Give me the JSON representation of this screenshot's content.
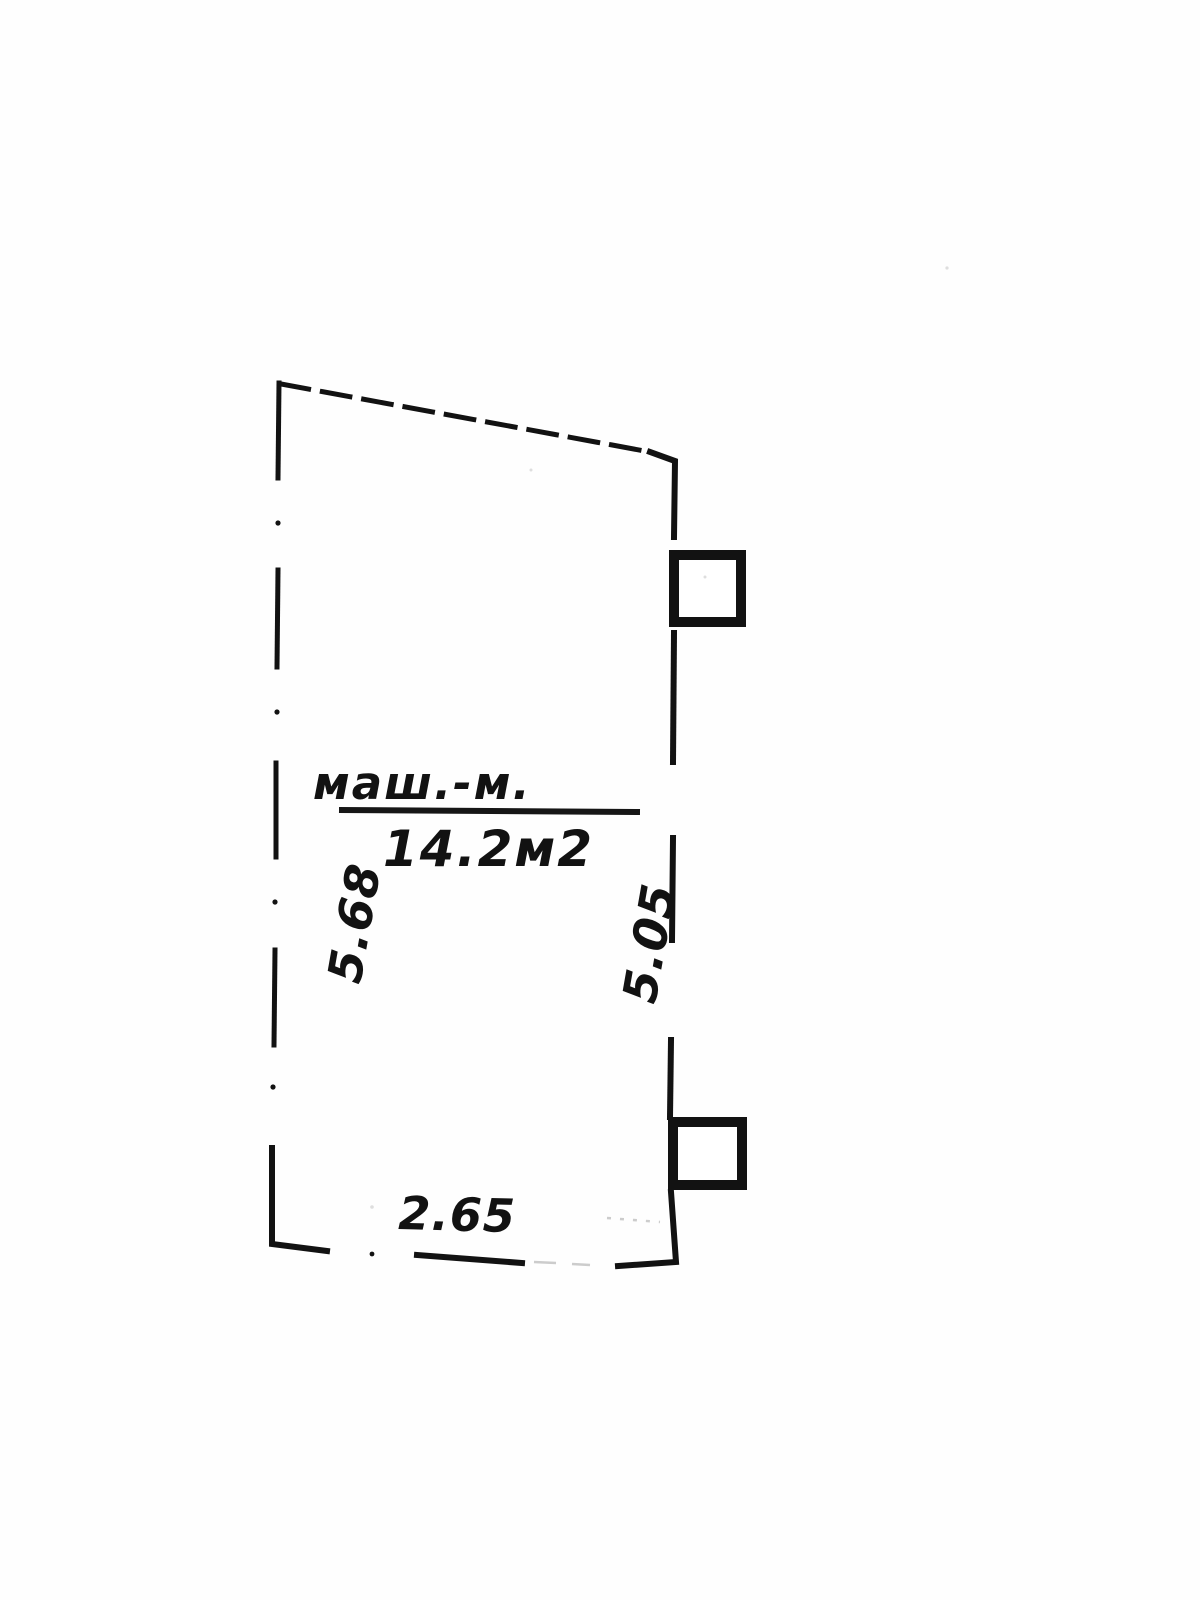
{
  "page": {
    "background": "#fefefe",
    "ink": "#121212",
    "faint": "#c0c0c0"
  },
  "plan": {
    "room_label": "маш.-м.",
    "area_label": "14.2м2",
    "dim_left": "5.68",
    "dim_right": "5.05",
    "dim_bottom": "2.65"
  }
}
